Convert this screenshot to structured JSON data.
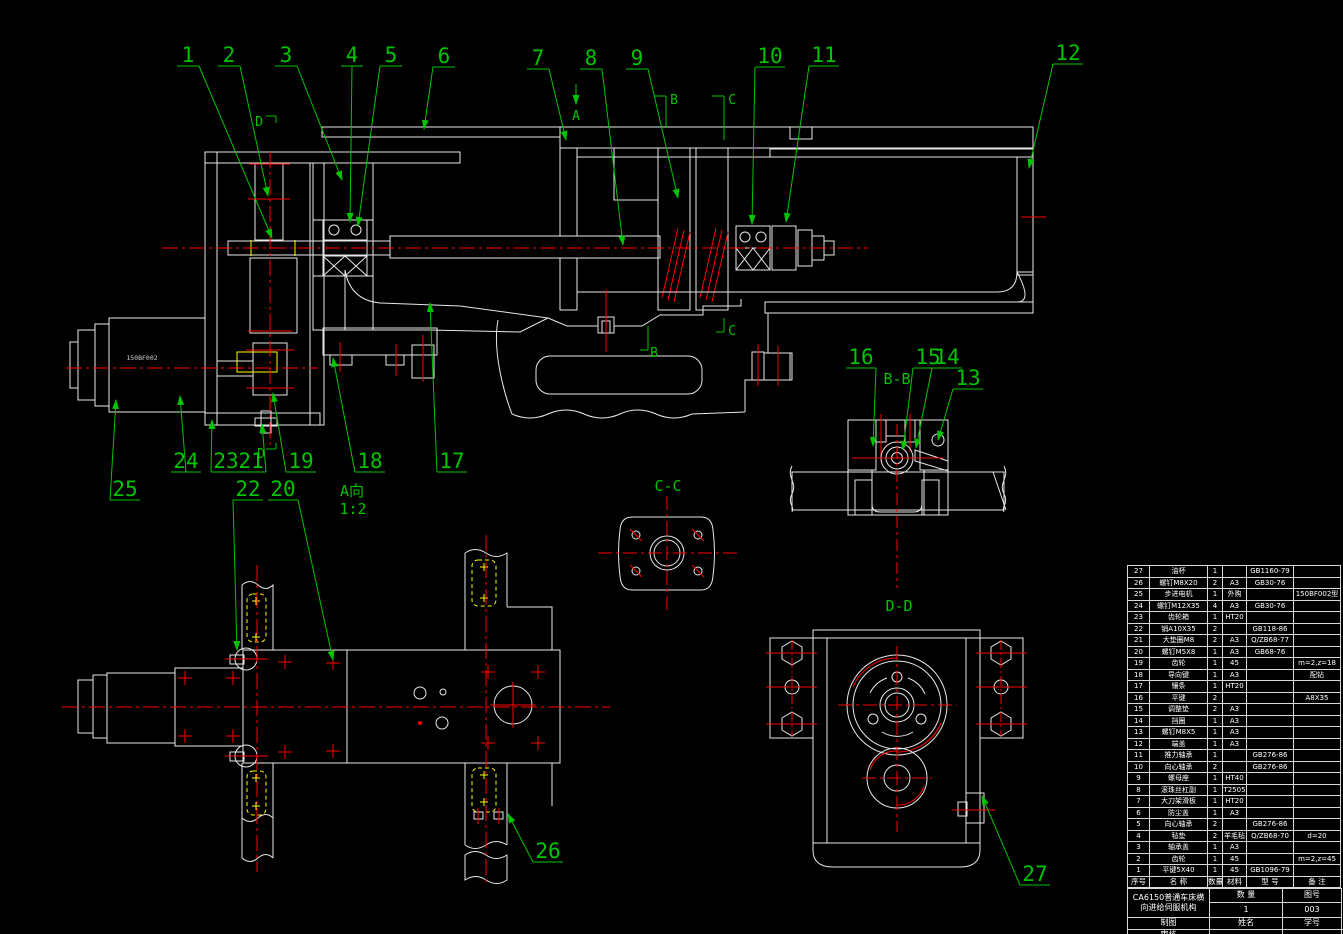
{
  "page": {
    "width": 1343,
    "height": 934,
    "background": "#000000"
  },
  "colors": {
    "line": "#e8e8e8",
    "annotation_green": "#00c400",
    "centerline_red": "#ff0000",
    "highlight_yellow": "#ffff00"
  },
  "motor_model_label": "150BF002",
  "view_labels": [
    {
      "text": "A向",
      "x": 352,
      "y": 496
    },
    {
      "text": "1:2",
      "x": 353,
      "y": 514
    },
    {
      "text": "B-B",
      "x": 897,
      "y": 384
    },
    {
      "text": "C-C",
      "x": 668,
      "y": 491
    },
    {
      "text": "D-D",
      "x": 899,
      "y": 611
    }
  ],
  "section_letters": [
    {
      "text": "A",
      "x": 576,
      "y": 120
    },
    {
      "text": "B",
      "x": 674,
      "y": 104
    },
    {
      "text": "C",
      "x": 732,
      "y": 104
    },
    {
      "text": "B",
      "x": 654,
      "y": 357
    },
    {
      "text": "C",
      "x": 732,
      "y": 335
    },
    {
      "text": "D",
      "x": 259,
      "y": 126
    },
    {
      "text": "D",
      "x": 261,
      "y": 458
    }
  ],
  "callouts": [
    {
      "label": "1",
      "x": 188,
      "y": 55,
      "tx": 272,
      "ty": 238
    },
    {
      "label": "2",
      "x": 229,
      "y": 55,
      "tx": 268,
      "ty": 196
    },
    {
      "label": "3",
      "x": 286,
      "y": 55,
      "tx": 342,
      "ty": 180
    },
    {
      "label": "4",
      "x": 352,
      "y": 55,
      "tx": 350,
      "ty": 222
    },
    {
      "label": "5",
      "x": 391,
      "y": 55,
      "tx": 358,
      "ty": 226
    },
    {
      "label": "6",
      "x": 444,
      "y": 56,
      "tx": 424,
      "ty": 129
    },
    {
      "label": "7",
      "x": 538,
      "y": 58,
      "tx": 566,
      "ty": 140
    },
    {
      "label": "8",
      "x": 591,
      "y": 58,
      "tx": 623,
      "ty": 245
    },
    {
      "label": "9",
      "x": 637,
      "y": 58,
      "tx": 678,
      "ty": 198
    },
    {
      "label": "10",
      "x": 770,
      "y": 56,
      "tx": 752,
      "ty": 224
    },
    {
      "label": "11",
      "x": 824,
      "y": 55,
      "tx": 786,
      "ty": 222
    },
    {
      "label": "12",
      "x": 1068,
      "y": 53,
      "tx": 1029,
      "ty": 168
    },
    {
      "label": "13",
      "x": 968,
      "y": 378,
      "tx": 938,
      "ty": 440
    },
    {
      "label": "14",
      "x": 947,
      "y": 357,
      "tx": 916,
      "ty": 448
    },
    {
      "label": "15",
      "x": 928,
      "y": 357,
      "tx": 903,
      "ty": 450
    },
    {
      "label": "16",
      "x": 861,
      "y": 357,
      "tx": 873,
      "ty": 446
    },
    {
      "label": "17",
      "x": 452,
      "y": 461,
      "tx": 430,
      "ty": 303
    },
    {
      "label": "18",
      "x": 370,
      "y": 461,
      "tx": 333,
      "ty": 358
    },
    {
      "label": "19",
      "x": 301,
      "y": 461,
      "tx": 273,
      "ty": 393
    },
    {
      "label": "20",
      "x": 283,
      "y": 489,
      "tx": 333,
      "ty": 660
    },
    {
      "label": "21",
      "x": 251,
      "y": 461,
      "tx": 262,
      "ty": 424
    },
    {
      "label": "22",
      "x": 248,
      "y": 489,
      "tx": 237,
      "ty": 650
    },
    {
      "label": "23",
      "x": 226,
      "y": 461,
      "tx": 212,
      "ty": 420
    },
    {
      "label": "24",
      "x": 186,
      "y": 461,
      "tx": 180,
      "ty": 396
    },
    {
      "label": "25",
      "x": 125,
      "y": 489,
      "tx": 116,
      "ty": 400
    },
    {
      "label": "26",
      "x": 548,
      "y": 851,
      "tx": 508,
      "ty": 814
    },
    {
      "label": "27",
      "x": 1035,
      "y": 874,
      "tx": 982,
      "ty": 796
    }
  ],
  "parts_table": {
    "columns": [
      "序号",
      "名  称",
      "数量",
      "材料",
      "型  号",
      "备  注"
    ],
    "rows": [
      [
        "27",
        "油杯",
        "1",
        "",
        "GB1160-79",
        ""
      ],
      [
        "26",
        "螺钉M8X20",
        "2",
        "A3",
        "GB30-76",
        ""
      ],
      [
        "25",
        "步进电机",
        "1",
        "外购",
        "",
        "150BF002型"
      ],
      [
        "24",
        "螺钉M12X35",
        "4",
        "A3",
        "GB30-76",
        ""
      ],
      [
        "23",
        "齿轮箱",
        "1",
        "HT20",
        "",
        ""
      ],
      [
        "22",
        "销A10X35",
        "2",
        "",
        "GB118-86",
        ""
      ],
      [
        "21",
        "大垫圈M8",
        "2",
        "A3",
        "Q/ZB68-77",
        ""
      ],
      [
        "20",
        "螺钉M5X8",
        "1",
        "A3",
        "GB68-76",
        ""
      ],
      [
        "19",
        "齿轮",
        "1",
        "45",
        "",
        "m=2,z=18"
      ],
      [
        "18",
        "导向键",
        "1",
        "A3",
        "",
        "配钻"
      ],
      [
        "17",
        "镶条",
        "1",
        "HT20",
        "",
        ""
      ],
      [
        "16",
        "平键",
        "2",
        "",
        "",
        "A8X35"
      ],
      [
        "15",
        "调整垫",
        "2",
        "A3",
        "",
        ""
      ],
      [
        "14",
        "挡圈",
        "1",
        "A3",
        "",
        ""
      ],
      [
        "13",
        "螺钉M8X5",
        "1",
        "A3",
        "",
        ""
      ],
      [
        "12",
        "端盖",
        "1",
        "A3",
        "",
        ""
      ],
      [
        "11",
        "推力轴承",
        "1",
        "",
        "GB276-86",
        ""
      ],
      [
        "10",
        "向心轴承",
        "2",
        "",
        "GB276-86",
        ""
      ],
      [
        "9",
        "螺母座",
        "1",
        "HT40",
        "",
        ""
      ],
      [
        "8",
        "滚珠丝杠副",
        "1",
        "T2505",
        "",
        ""
      ],
      [
        "7",
        "大刀架滑板",
        "1",
        "HT20",
        "",
        ""
      ],
      [
        "6",
        "防尘盖",
        "1",
        "A3",
        "",
        ""
      ],
      [
        "5",
        "向心轴承",
        "2",
        "",
        "GB276-86",
        ""
      ],
      [
        "4",
        "毡垫",
        "2",
        "羊毛毡",
        "Q/ZB68-70",
        "d=20"
      ],
      [
        "3",
        "轴承盖",
        "1",
        "A3",
        "",
        ""
      ],
      [
        "2",
        "齿轮",
        "1",
        "45",
        "",
        "m=2,z=45"
      ],
      [
        "1",
        "平键5X40",
        "1",
        "45",
        "GB1096-79",
        ""
      ]
    ],
    "title_block": {
      "project_line1": "CA6150普通车床横",
      "project_line2": "向进给伺服机构",
      "qty_label": "数  量",
      "qty_value": "1",
      "dwg_no_label": "图号",
      "dwg_no_value": "003",
      "drafter_label": "制图",
      "name_label": "姓名",
      "student_no_label": "学号",
      "checker_label": "审核"
    }
  }
}
